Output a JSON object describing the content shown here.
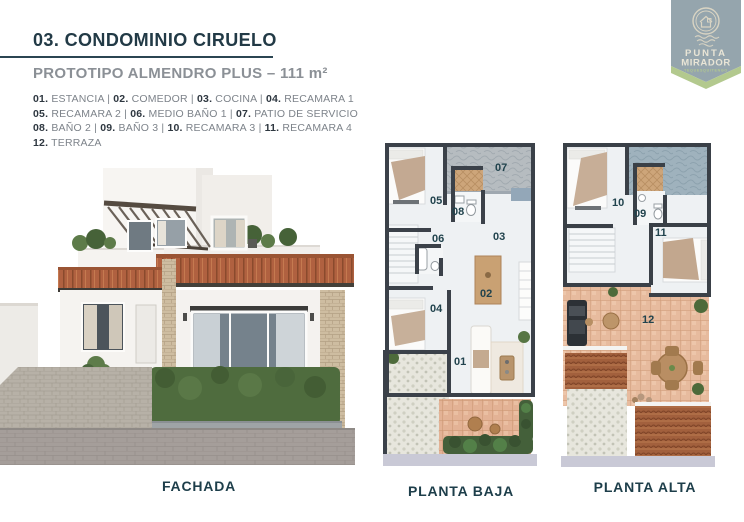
{
  "page": {
    "title": "03. CONDOMINIO CIRUELO",
    "subtitle": "PROTOTIPO ALMENDRO PLUS – 111 m²"
  },
  "legend": {
    "separator": "|",
    "lines": [
      [
        {
          "num": "01.",
          "name": "ESTANCIA"
        },
        {
          "num": "02.",
          "name": "COMEDOR"
        },
        {
          "num": "03.",
          "name": "COCINA"
        },
        {
          "num": "04.",
          "name": "RECAMARA 1"
        }
      ],
      [
        {
          "num": "05.",
          "name": "RECAMARA 2"
        },
        {
          "num": "06.",
          "name": "MEDIO BAÑO 1"
        },
        {
          "num": "07.",
          "name": "PATIO DE SERVICIO"
        }
      ],
      [
        {
          "num": "08.",
          "name": "BAÑO 2"
        },
        {
          "num": "09.",
          "name": "BAÑO 3"
        },
        {
          "num": "10.",
          "name": "RECAMARA 3"
        },
        {
          "num": "11.",
          "name": "RECAMARA 4"
        }
      ],
      [
        {
          "num": "12.",
          "name": "TERRAZA"
        }
      ]
    ]
  },
  "logo": {
    "line1": "PUNTA",
    "line2": "MIRADOR",
    "line3": "TEQUESQUITENGO"
  },
  "plans": {
    "fachada": {
      "caption": "FACHADA"
    },
    "baja": {
      "caption": "PLANTA BAJA",
      "labels": [
        "05",
        "07",
        "08",
        "06",
        "03",
        "02",
        "04",
        "01"
      ]
    },
    "alta": {
      "caption": "PLANTA ALTA",
      "labels": [
        "10",
        "09",
        "11",
        "12"
      ]
    }
  },
  "colors": {
    "title": "#223a46",
    "subtitle_gray": "#8b9096",
    "legend_gray": "#7d838a",
    "caption_teal": "#1d3e4a",
    "logo_banner": "#95a5ad",
    "logo_green": "#b3c98e",
    "logo_cream": "#ded9c8",
    "plan_wall": "#3a4149",
    "roof_terracotta": "#b06140"
  }
}
